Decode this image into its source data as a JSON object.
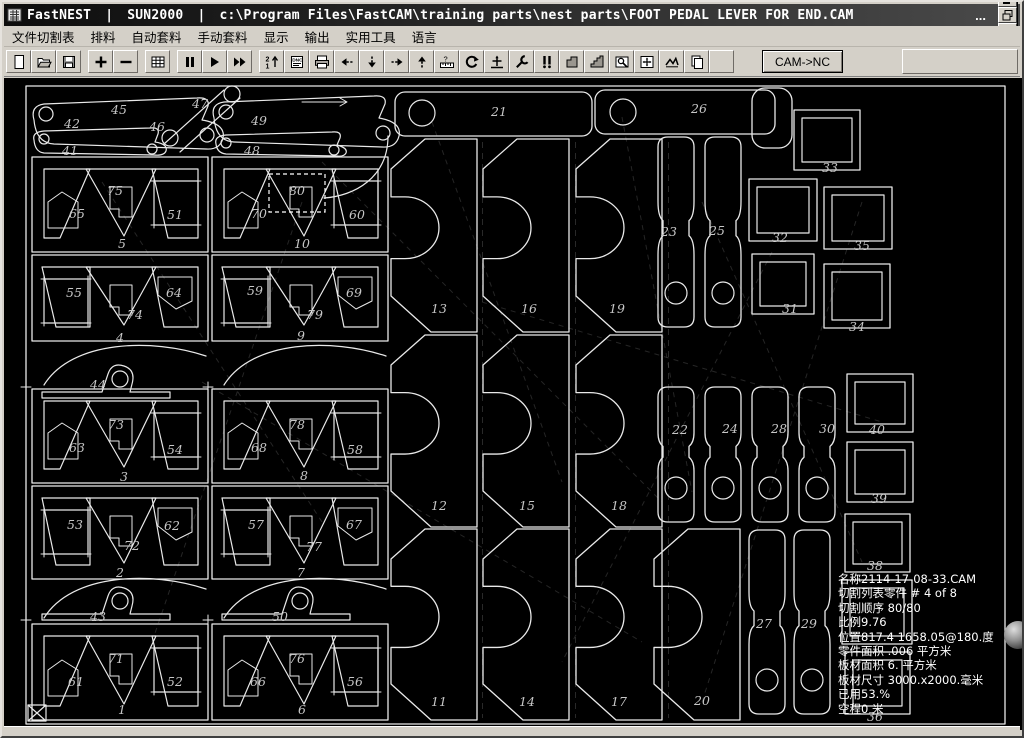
{
  "window": {
    "app_title": "FastNEST",
    "system_title": "SUN2000",
    "file_path": "c:\\Program Files\\FastCAM\\training parts\\nest parts\\FOOT PEDAL LEVER FOR END.CAM",
    "separator": "|",
    "overflow_indicator": "...",
    "controls": [
      {
        "name": "minimize-button"
      },
      {
        "name": "restore-button"
      },
      {
        "name": "close-button"
      }
    ]
  },
  "menu": {
    "items": [
      "文件切割表",
      "排料",
      "自动套料",
      "手动套料",
      "显示",
      "输出",
      "实用工具",
      "语言"
    ]
  },
  "toolbar": {
    "cam_nc_label": "CAM->NC",
    "buttons": [
      {
        "name": "new-file-icon"
      },
      {
        "name": "open-file-icon"
      },
      {
        "name": "save-file-icon"
      },
      {
        "name": "zoom-in-icon"
      },
      {
        "name": "zoom-out-icon"
      },
      {
        "name": "grid-icon"
      },
      {
        "name": "pause-icon"
      },
      {
        "name": "run-icon"
      },
      {
        "name": "fast-run-icon"
      },
      {
        "name": "cut-sequence-icon"
      },
      {
        "name": "nc-code-icon"
      },
      {
        "name": "print-icon"
      },
      {
        "name": "move-left-icon"
      },
      {
        "name": "move-down-icon"
      },
      {
        "name": "move-right-icon"
      },
      {
        "name": "move-up-icon"
      },
      {
        "name": "measure-icon"
      },
      {
        "name": "rotate-icon"
      },
      {
        "name": "datum-cross-icon"
      },
      {
        "name": "tools-icon"
      },
      {
        "name": "pin-parts-icon"
      },
      {
        "name": "corner-profile-icon"
      },
      {
        "name": "step-profile-icon"
      },
      {
        "name": "zoom-window-icon"
      },
      {
        "name": "fit-view-icon"
      },
      {
        "name": "collision-check-icon"
      },
      {
        "name": "copy-part-icon"
      },
      {
        "name": "blank-icon"
      }
    ]
  },
  "nest": {
    "colors": {
      "background": "#000000",
      "line": "#e9e9e9",
      "label": "#c6c6c6"
    },
    "sheet_size_note": "3000.x2000.",
    "part_labels": [
      {
        "n": "1",
        "x": 120,
        "y": 712
      },
      {
        "n": "2",
        "x": 118,
        "y": 575
      },
      {
        "n": "3",
        "x": 122,
        "y": 479
      },
      {
        "n": "4",
        "x": 118,
        "y": 340
      },
      {
        "n": "5",
        "x": 120,
        "y": 246
      },
      {
        "n": "6",
        "x": 300,
        "y": 712
      },
      {
        "n": "7",
        "x": 299,
        "y": 575
      },
      {
        "n": "8",
        "x": 302,
        "y": 478
      },
      {
        "n": "9",
        "x": 299,
        "y": 338
      },
      {
        "n": "10",
        "x": 300,
        "y": 246
      },
      {
        "n": "11",
        "x": 437,
        "y": 704
      },
      {
        "n": "12",
        "x": 437,
        "y": 508
      },
      {
        "n": "13",
        "x": 437,
        "y": 311
      },
      {
        "n": "14",
        "x": 525,
        "y": 704
      },
      {
        "n": "15",
        "x": 525,
        "y": 508
      },
      {
        "n": "16",
        "x": 527,
        "y": 311
      },
      {
        "n": "17",
        "x": 617,
        "y": 704
      },
      {
        "n": "18",
        "x": 617,
        "y": 508
      },
      {
        "n": "19",
        "x": 615,
        "y": 311
      },
      {
        "n": "20",
        "x": 700,
        "y": 703
      },
      {
        "n": "21",
        "x": 497,
        "y": 114
      },
      {
        "n": "22",
        "x": 678,
        "y": 432
      },
      {
        "n": "23",
        "x": 667,
        "y": 234
      },
      {
        "n": "24",
        "x": 728,
        "y": 431
      },
      {
        "n": "25",
        "x": 715,
        "y": 233
      },
      {
        "n": "26",
        "x": 697,
        "y": 111
      },
      {
        "n": "27",
        "x": 762,
        "y": 626
      },
      {
        "n": "28",
        "x": 777,
        "y": 431
      },
      {
        "n": "29",
        "x": 807,
        "y": 626
      },
      {
        "n": "30",
        "x": 825,
        "y": 431
      },
      {
        "n": "31",
        "x": 788,
        "y": 311
      },
      {
        "n": "32",
        "x": 778,
        "y": 240
      },
      {
        "n": "33",
        "x": 828,
        "y": 170
      },
      {
        "n": "34",
        "x": 855,
        "y": 329
      },
      {
        "n": "35",
        "x": 860,
        "y": 248
      },
      {
        "n": "36",
        "x": 873,
        "y": 719
      },
      {
        "n": "38",
        "x": 873,
        "y": 568
      },
      {
        "n": "39",
        "x": 877,
        "y": 501
      },
      {
        "n": "40",
        "x": 875,
        "y": 432
      },
      {
        "n": "41",
        "x": 68,
        "y": 153
      },
      {
        "n": "42",
        "x": 70,
        "y": 126
      },
      {
        "n": "43",
        "x": 96,
        "y": 619
      },
      {
        "n": "44",
        "x": 96,
        "y": 387
      },
      {
        "n": "45",
        "x": 117,
        "y": 112
      },
      {
        "n": "46",
        "x": 155,
        "y": 129
      },
      {
        "n": "47",
        "x": 198,
        "y": 106
      },
      {
        "n": "48",
        "x": 250,
        "y": 153
      },
      {
        "n": "49",
        "x": 257,
        "y": 123
      },
      {
        "n": "50",
        "x": 278,
        "y": 619
      },
      {
        "n": "51",
        "x": 173,
        "y": 217
      },
      {
        "n": "52",
        "x": 173,
        "y": 684
      },
      {
        "n": "53",
        "x": 73,
        "y": 527
      },
      {
        "n": "54",
        "x": 173,
        "y": 452
      },
      {
        "n": "55",
        "x": 72,
        "y": 295
      },
      {
        "n": "56",
        "x": 353,
        "y": 684
      },
      {
        "n": "57",
        "x": 254,
        "y": 527
      },
      {
        "n": "58",
        "x": 353,
        "y": 452
      },
      {
        "n": "59",
        "x": 253,
        "y": 293
      },
      {
        "n": "60",
        "x": 355,
        "y": 217
      },
      {
        "n": "61",
        "x": 74,
        "y": 684
      },
      {
        "n": "62",
        "x": 170,
        "y": 528
      },
      {
        "n": "63",
        "x": 75,
        "y": 450
      },
      {
        "n": "64",
        "x": 172,
        "y": 295
      },
      {
        "n": "65",
        "x": 75,
        "y": 216
      },
      {
        "n": "66",
        "x": 256,
        "y": 684
      },
      {
        "n": "67",
        "x": 352,
        "y": 527
      },
      {
        "n": "68",
        "x": 257,
        "y": 450
      },
      {
        "n": "69",
        "x": 352,
        "y": 295
      },
      {
        "n": "70",
        "x": 257,
        "y": 216
      },
      {
        "n": "71",
        "x": 114,
        "y": 661
      },
      {
        "n": "72",
        "x": 130,
        "y": 548
      },
      {
        "n": "73",
        "x": 114,
        "y": 427
      },
      {
        "n": "74",
        "x": 133,
        "y": 317
      },
      {
        "n": "75",
        "x": 113,
        "y": 193
      },
      {
        "n": "76",
        "x": 295,
        "y": 661
      },
      {
        "n": "77",
        "x": 312,
        "y": 549
      },
      {
        "n": "78",
        "x": 295,
        "y": 427
      },
      {
        "n": "79",
        "x": 313,
        "y": 317
      },
      {
        "n": "80",
        "x": 295,
        "y": 193
      }
    ],
    "status_lines": [
      "名称2114-17-08-33.CAM",
      "切割列表零件  # 4 of  8",
      "切割顺序 80/80",
      "比例9.76",
      "位置817.4 1658.05@180.度",
      "零件面积 .006 平方米",
      "板材面积 6. 平方米",
      "板材尺寸  3000.x2000.毫米",
      "已用53.%",
      "空程0 米"
    ]
  }
}
